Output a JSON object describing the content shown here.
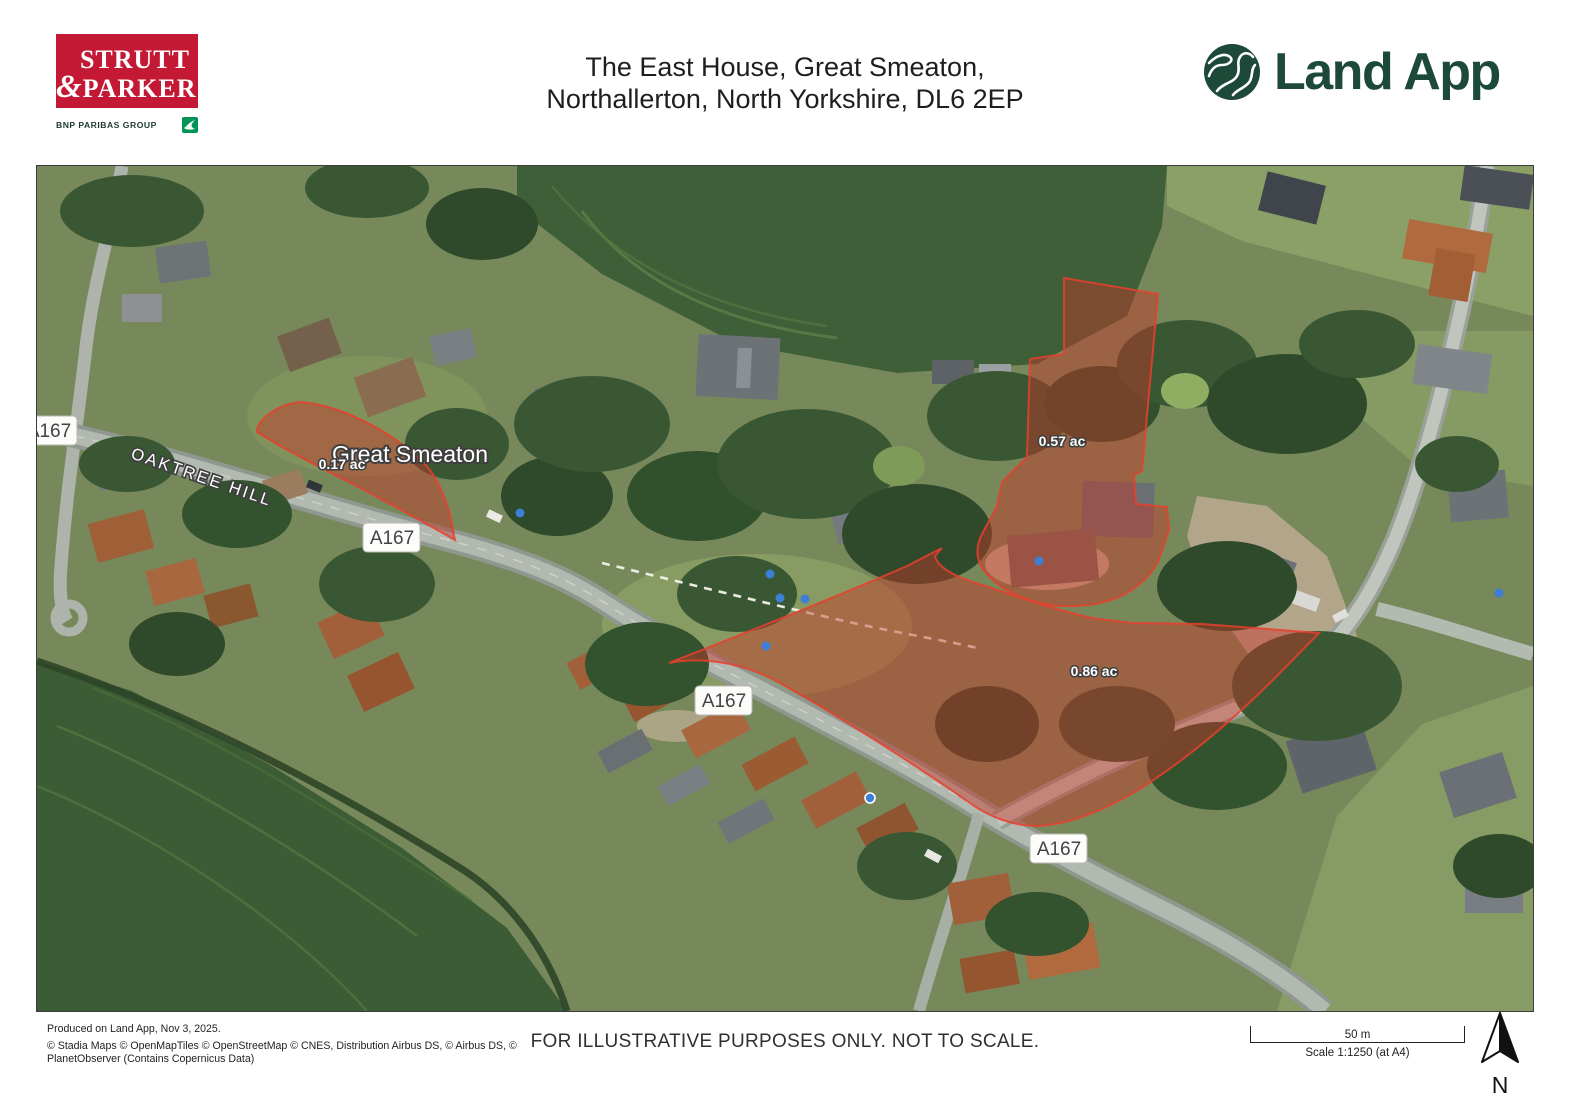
{
  "header": {
    "brand": {
      "name_top": "STRUTT",
      "ampersand": "&",
      "name_bottom": "PARKER",
      "group": "BNP PARIBAS GROUP"
    },
    "title": {
      "line1": "The East House, Great Smeaton,",
      "line2": "Northallerton, North Yorkshire, DL6 2EP"
    },
    "landapp_wordmark": "Land App"
  },
  "map": {
    "place_label": "Great Smeaton",
    "street_label": "OAKTREE HILL",
    "road_badges": [
      "A167",
      "A167",
      "A167",
      "A167"
    ],
    "parcels": [
      {
        "area": "0.17 ac"
      },
      {
        "area": "0.57 ac"
      },
      {
        "area": "0.86 ac"
      }
    ],
    "colors": {
      "parcel_fill": "#c73527",
      "parcel_stroke": "#e8402e",
      "brand_red": "#c41935",
      "landapp_green": "#1d4939"
    }
  },
  "footer": {
    "produced": "Produced on Land App, Nov 3, 2025.",
    "attribution_line1": "© Stadia Maps © OpenMapTiles © OpenStreetMap © CNES, Distribution Airbus DS, © Airbus DS, ©",
    "attribution_line2": "PlanetObserver (Contains Copernicus Data)",
    "disclaimer": "FOR ILLUSTRATIVE PURPOSES ONLY. NOT TO SCALE.",
    "scale_label": "50 m",
    "scale_ratio": "Scale 1:1250 (at A4)",
    "north_label": "N"
  }
}
